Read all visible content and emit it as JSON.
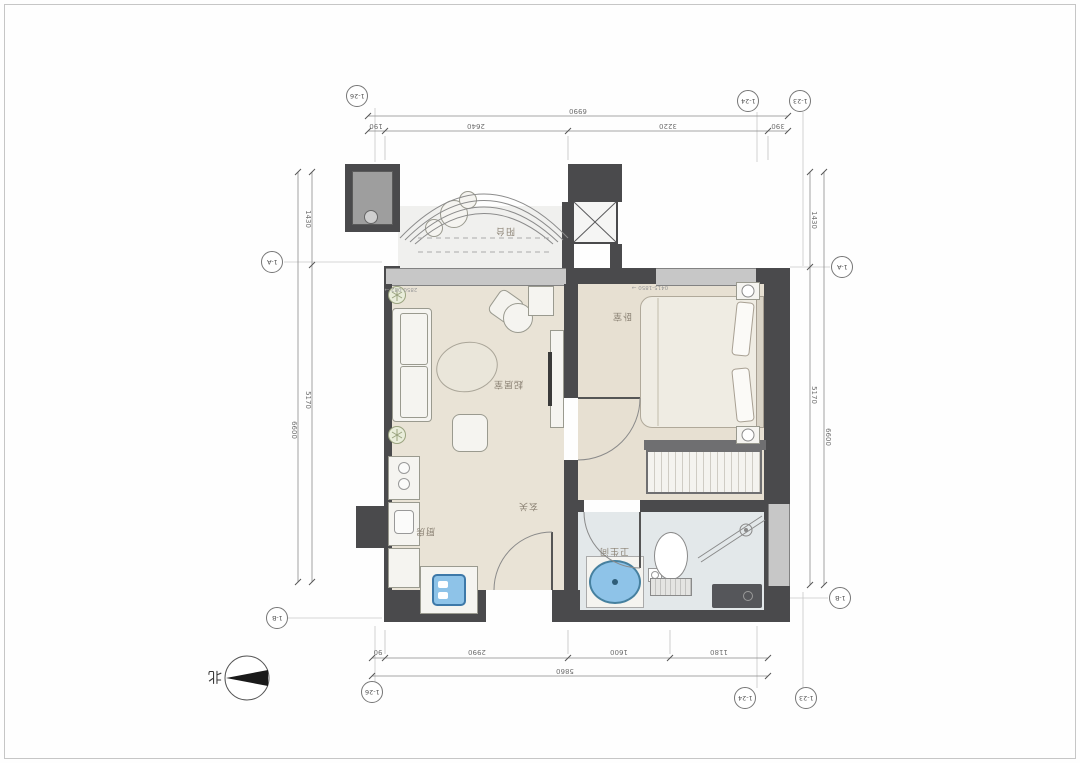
{
  "drawing": {
    "kind": "apartment floor plan",
    "orientation": "rotated-180"
  },
  "north": {
    "label": "北"
  },
  "grid_bubbles": {
    "top": [
      "1-26",
      "1-24",
      "1-23"
    ],
    "bottom": [
      "1-26",
      "1-24",
      "1-23"
    ],
    "left": [
      "1-A",
      "1-B"
    ],
    "right": [
      "1-A",
      "1-B"
    ]
  },
  "dimensions": {
    "top": {
      "total": "6990",
      "segments": [
        "190",
        "2640",
        "3220",
        "390"
      ]
    },
    "bottom": {
      "total": "5860",
      "segments": [
        "90",
        "2990",
        "1600",
        "1180"
      ]
    },
    "left": {
      "total": "6600",
      "segments": [
        "1430",
        "5170"
      ]
    },
    "right": {
      "total": "6600",
      "segments": [
        "1430",
        "5170"
      ]
    }
  },
  "rooms": {
    "balcony": "阳台",
    "living_room": "起居室",
    "bedroom": "卧室",
    "bathroom": "卫生间",
    "kitchen": "厨房",
    "entry": "玄关"
  },
  "annotations": {
    "window_tag_left": "2850-082 →",
    "window_tag_right": "0415-1850 →"
  },
  "colors": {
    "wall": "#4a4a4c",
    "floor_warm": "#e9e3d6",
    "floor_bath": "#e3e8ea",
    "glass": "#c7c7c7",
    "fixture_blue": "#8ec3e8",
    "mat_dark": "#55565a"
  }
}
